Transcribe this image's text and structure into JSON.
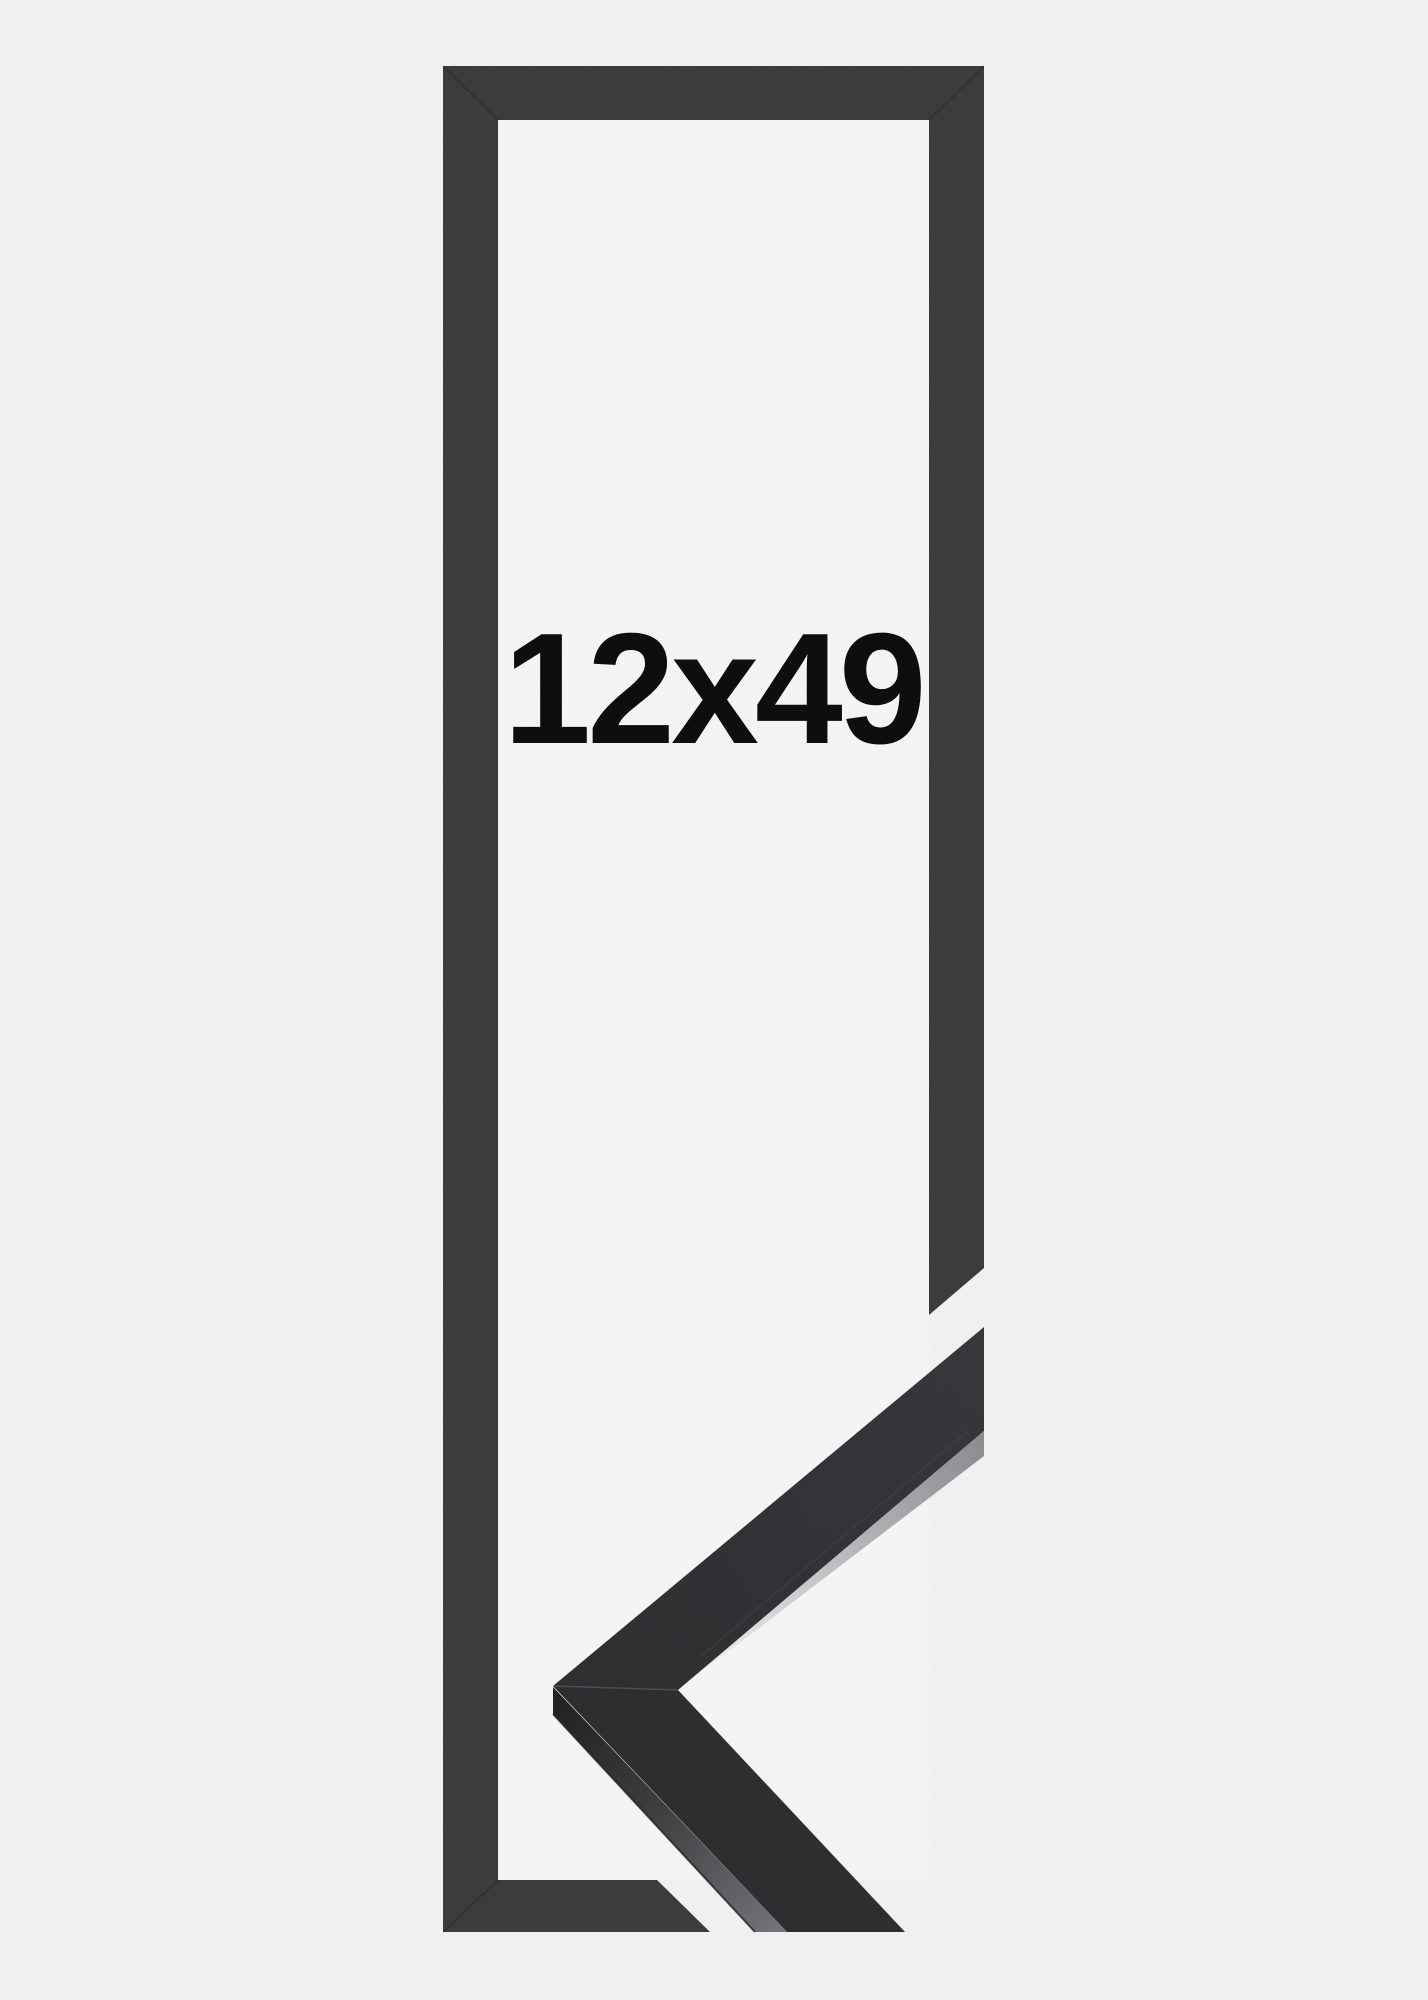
{
  "product": {
    "size_label": "12x49"
  },
  "colors": {
    "background": "#f1f1f2",
    "inner_background": "#f5f5f6",
    "frame_graphic": "#38393b",
    "sample_face_upper": "#2d2e30",
    "sample_face_lower": "#2a2b2d",
    "sample_side_dark": "#1e1f21",
    "sample_side_light": "#707174",
    "sample_top_sliver": "#828386",
    "label_text": "#0a0a0a"
  }
}
